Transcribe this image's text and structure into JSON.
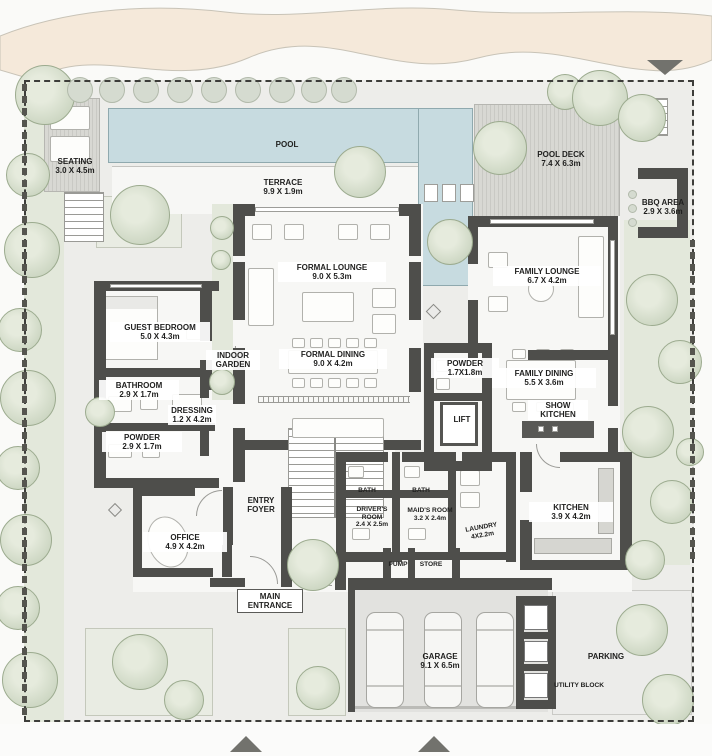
{
  "colors": {
    "sand": "#f5e9da",
    "ground": "#ededea",
    "room": "#f7f7f5",
    "wall": "#4e4e4b",
    "pool": "#c7dbe0",
    "green": "#e3e8db",
    "tree": "#ccd6c2",
    "deck": "#d8d8d3",
    "arrow": "#72726d",
    "text": "#1f1f1e",
    "boundary": "#3d3d3a"
  },
  "labels": {
    "seating": {
      "name": "SEATING",
      "dims": "3.0 X 4.5m"
    },
    "pool": {
      "name": "POOL"
    },
    "terrace": {
      "name": "TERRACE",
      "dims": "9.9 X 1.9m"
    },
    "pool_deck": {
      "name": "POOL DECK",
      "dims": "7.4 X 6.3m"
    },
    "bbq_area": {
      "name": "BBQ AREA",
      "dims": "2.9 X 3.6m"
    },
    "formal_lounge": {
      "name": "FORMAL LOUNGE",
      "dims": "9.0 X 5.3m"
    },
    "family_lounge": {
      "name": "FAMILY LOUNGE",
      "dims": "6.7 X 4.2m"
    },
    "guest_bedroom": {
      "name": "GUEST BEDROOM",
      "dims": "5.0 X 4.3m"
    },
    "indoor_garden": {
      "name": "INDOOR GARDEN"
    },
    "formal_dining": {
      "name": "FORMAL DINING",
      "dims": "9.0 X 4.2m"
    },
    "bathroom": {
      "name": "BATHROOM",
      "dims": "2.9 X 1.7m"
    },
    "dressing": {
      "name": "DRESSING",
      "dims": "1.2 X 4.2m"
    },
    "powder_guest": {
      "name": "POWDER",
      "dims": "2.9 X 1.7m"
    },
    "powder_family": {
      "name": "POWDER",
      "dims": "1.7X1.8m"
    },
    "lift": {
      "name": "LIFT"
    },
    "family_dining": {
      "name": "FAMILY DINING",
      "dims": "5.5 X 3.6m"
    },
    "show_kitchen": {
      "name": "SHOW KITCHEN"
    },
    "entry_foyer": {
      "name": "ENTRY FOYER"
    },
    "office": {
      "name": "OFFICE",
      "dims": "4.9 X 4.2m"
    },
    "main_entrance": {
      "name": "MAIN ENTRANCE"
    },
    "bath_drivers": {
      "name": "BATH"
    },
    "bath_maids": {
      "name": "BATH"
    },
    "drivers_room": {
      "name": "DRIVER'S ROOM",
      "dims": "2.4 X 2.5m"
    },
    "maids_room": {
      "name": "MAID'S ROOM",
      "dims": "3.2 X 2.4m"
    },
    "laundry": {
      "name": "LAUNDRY",
      "dims": "4X2.2m"
    },
    "pump": {
      "name": "PUMP"
    },
    "store": {
      "name": "STORE"
    },
    "kitchen": {
      "name": "KITCHEN",
      "dims": "3.9 X 4.2m"
    },
    "garage": {
      "name": "GARAGE",
      "dims": "9.1 X 6.5m"
    },
    "parking": {
      "name": "PARKING"
    },
    "utility_block": {
      "name": "UTILITY BLOCK"
    }
  }
}
